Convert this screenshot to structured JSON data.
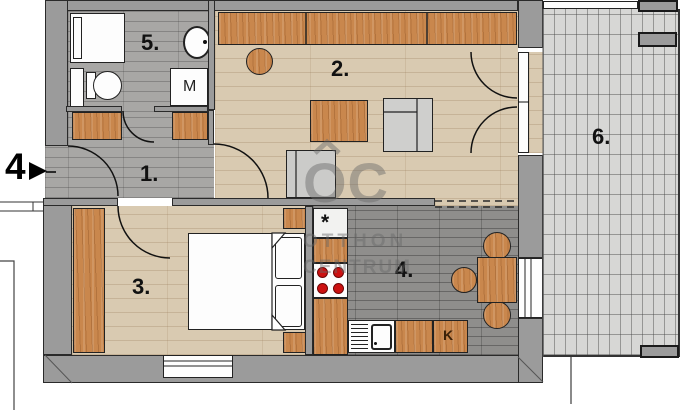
{
  "plan": {
    "title": "apartment floor plan",
    "unit_label": "4",
    "rooms": [
      {
        "name": "hallway",
        "label": "1."
      },
      {
        "name": "living-room",
        "label": "2."
      },
      {
        "name": "bedroom",
        "label": "3."
      },
      {
        "name": "kitchen",
        "label": "4."
      },
      {
        "name": "bathroom",
        "label": "5."
      },
      {
        "name": "terrace",
        "label": "6."
      }
    ],
    "appliances": {
      "washing_machine": "M",
      "fridge": "K",
      "star_mark": "*"
    },
    "watermark": {
      "logo": "OC",
      "line1": "OTTHON",
      "line2": "CENTRUM"
    },
    "colors": {
      "wall": "#9b9b9b",
      "wood_furniture": "#c9874d",
      "light_floor": "#d9cab1",
      "gray_floor": "#a8a7a5",
      "kitchen_floor": "#8f8e8c",
      "terrace_tile": "#d7d7d5",
      "burner_red": "#cc1111"
    }
  }
}
